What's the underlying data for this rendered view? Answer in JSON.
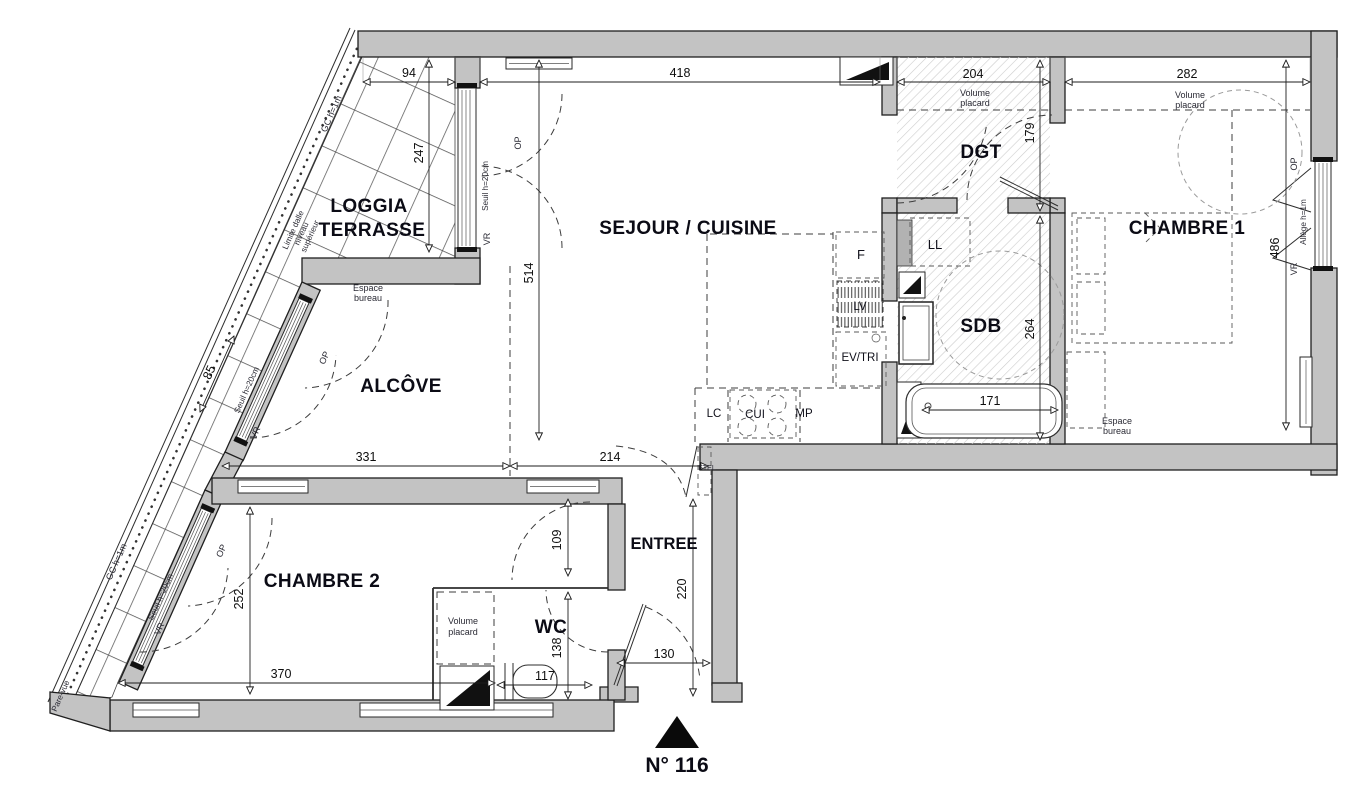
{
  "rooms": {
    "loggia_line1": "LOGGIA",
    "loggia_line2": "TERRASSE",
    "sejour": "SEJOUR / CUISINE",
    "alcove": "ALCÔVE",
    "chambre1": "CHAMBRE 1",
    "chambre2": "CHAMBRE 2",
    "entree": "ENTREE",
    "wc": "WC",
    "sdb": "SDB",
    "dgt": "DGT"
  },
  "equipment": {
    "ll": "LL",
    "f": "F",
    "lv": "LV",
    "ev_tri": "EV/TRI",
    "lc": "LC",
    "cui": "CUI",
    "mp": "MP",
    "etel": "ETEL"
  },
  "annotations": {
    "volume_line1": "Volume",
    "volume_line2": "placard",
    "espace_line1": "Espace",
    "espace_line2": "bureau",
    "seuil": "Seuil h=20cm",
    "op": "OP",
    "vr": "VR",
    "gc": "GC h=1m",
    "allege": "Allège h=1m",
    "limite_line1": "Limite dalle",
    "limite_line2": "niveau",
    "limite_line3": "supérieur",
    "pare_vue": "Pare-vue"
  },
  "dimensions": {
    "loggia_width": "94",
    "sejour_width": "418",
    "dgt_width": "204",
    "chambre1_width": "282",
    "loggia_depth": "247",
    "sejour_depth": "514",
    "dgt_depth": "179",
    "chambre1_depth": "486",
    "sdb_depth": "264",
    "baignoire_width": "171",
    "loggia_band": "85",
    "alcove_width": "331",
    "sejour_entree": "214",
    "entree_passage": "109",
    "entree_depth": "220",
    "chambre2_depth": "252",
    "chambre2_width": "370",
    "wc_width": "117",
    "wc_depth": "138",
    "porte_entree": "130"
  },
  "unit": {
    "label": "N° 116"
  }
}
